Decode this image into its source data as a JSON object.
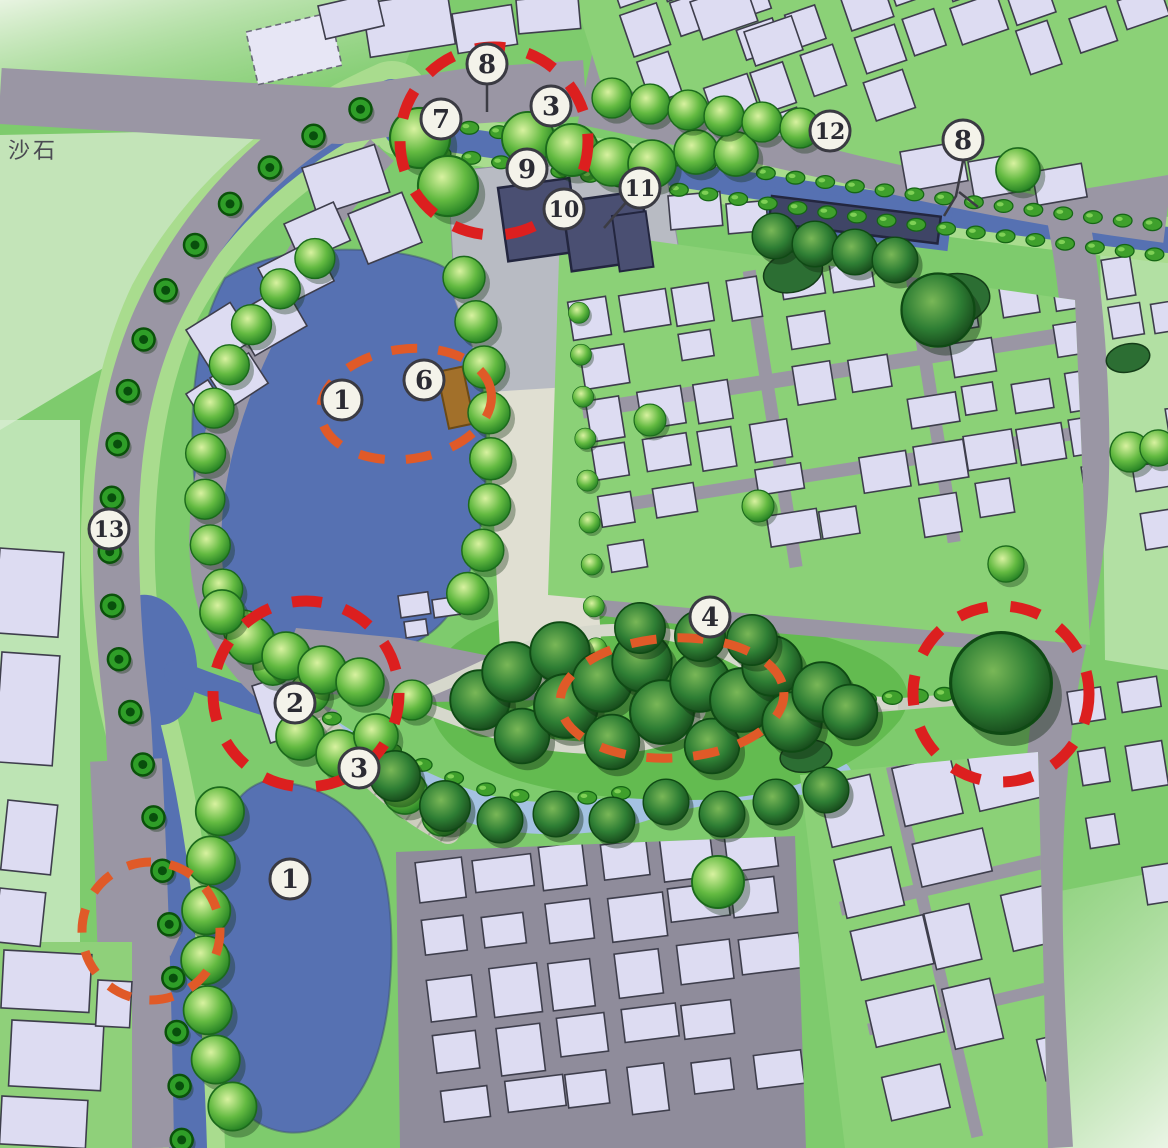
{
  "map": {
    "type": "landscape-master-plan",
    "area_label": "沙石"
  },
  "markers": [
    {
      "id": "m8-top",
      "label": "8",
      "x": 487,
      "y": 64,
      "leaders": [
        [
          [
            487,
            85
          ],
          [
            487,
            112
          ]
        ]
      ]
    },
    {
      "id": "m3-top",
      "label": "3",
      "x": 551,
      "y": 106,
      "leaders": []
    },
    {
      "id": "m7",
      "label": "7",
      "x": 441,
      "y": 119,
      "leaders": []
    },
    {
      "id": "m9",
      "label": "9",
      "x": 527,
      "y": 169,
      "leaders": []
    },
    {
      "id": "m10",
      "label": "10",
      "x": 564,
      "y": 209,
      "leaders": []
    },
    {
      "id": "m11",
      "label": "11",
      "x": 640,
      "y": 188,
      "leaders": [
        [
          [
            628,
            200
          ],
          [
            604,
            228
          ]
        ]
      ]
    },
    {
      "id": "m12",
      "label": "12",
      "x": 830,
      "y": 131,
      "leaders": []
    },
    {
      "id": "m8-right",
      "label": "8",
      "x": 963,
      "y": 140,
      "leaders": [
        [
          [
            963,
            161
          ],
          [
            956,
            196
          ],
          [
            944,
            216
          ]
        ],
        [
          [
            959,
            192
          ],
          [
            978,
            207
          ]
        ]
      ]
    },
    {
      "id": "m1-upper",
      "label": "1",
      "x": 342,
      "y": 400,
      "leaders": []
    },
    {
      "id": "m6",
      "label": "6",
      "x": 424,
      "y": 380,
      "leaders": []
    },
    {
      "id": "m13",
      "label": "13",
      "x": 109,
      "y": 529,
      "leaders": []
    },
    {
      "id": "m2",
      "label": "2",
      "x": 295,
      "y": 703,
      "leaders": []
    },
    {
      "id": "m3-mid",
      "label": "3",
      "x": 359,
      "y": 768,
      "leaders": []
    },
    {
      "id": "m4",
      "label": "4",
      "x": 710,
      "y": 617,
      "leaders": []
    },
    {
      "id": "m1-lower",
      "label": "1",
      "x": 290,
      "y": 879,
      "leaders": []
    }
  ],
  "highlight_circles": [
    {
      "id": "h-top-plaza",
      "shape": "circle",
      "cx": 494,
      "cy": 141,
      "r": 94,
      "color": "#dc1f1f",
      "width": 11,
      "dash": "30 23",
      "rot": 0
    },
    {
      "id": "h-crossing",
      "shape": "circle",
      "cx": 306,
      "cy": 694,
      "r": 93,
      "color": "#dc1f1f",
      "width": 11,
      "dash": "30 23",
      "rot": 0
    },
    {
      "id": "h-east-tree",
      "shape": "circle",
      "cx": 1001,
      "cy": 694,
      "r": 88,
      "color": "#dc1f1f",
      "width": 11,
      "dash": "30 23",
      "rot": 0
    },
    {
      "id": "h-lake-stage",
      "shape": "ellipse",
      "cx": 406,
      "cy": 404,
      "rx": 86,
      "ry": 55,
      "color": "#e05a28",
      "width": 9,
      "dash": "26 21",
      "rot": -8
    },
    {
      "id": "h-garden",
      "shape": "ellipse",
      "cx": 672,
      "cy": 698,
      "rx": 112,
      "ry": 60,
      "color": "#e05a28",
      "width": 9,
      "dash": "26 21",
      "rot": -3
    },
    {
      "id": "h-west-bridge",
      "shape": "circle",
      "cx": 151,
      "cy": 931,
      "r": 69,
      "color": "#e05a28",
      "width": 9,
      "dash": "24 19",
      "rot": 0
    }
  ],
  "colors": {
    "park_green": "#7ecb6d",
    "bank_green": "#a9dc8e",
    "water": "#5671b2",
    "stream": "#a4c2e2",
    "road": "#9a96a4",
    "building": "#dddcf2",
    "building_stroke": "#3e3e4c",
    "plaza": "#e0dfd2",
    "plaza_gray": "#b8bbc3",
    "pavilion_dark": "#4a4f72",
    "stage_brown": "#a2702a",
    "annotation_red": "#dc1f1f",
    "annotation_orange": "#e05a28",
    "marker_fill": "#f4f3ea",
    "marker_stroke": "#3a3a42",
    "marker_number": "#2b2b33",
    "label_text": "#4a4a52"
  }
}
